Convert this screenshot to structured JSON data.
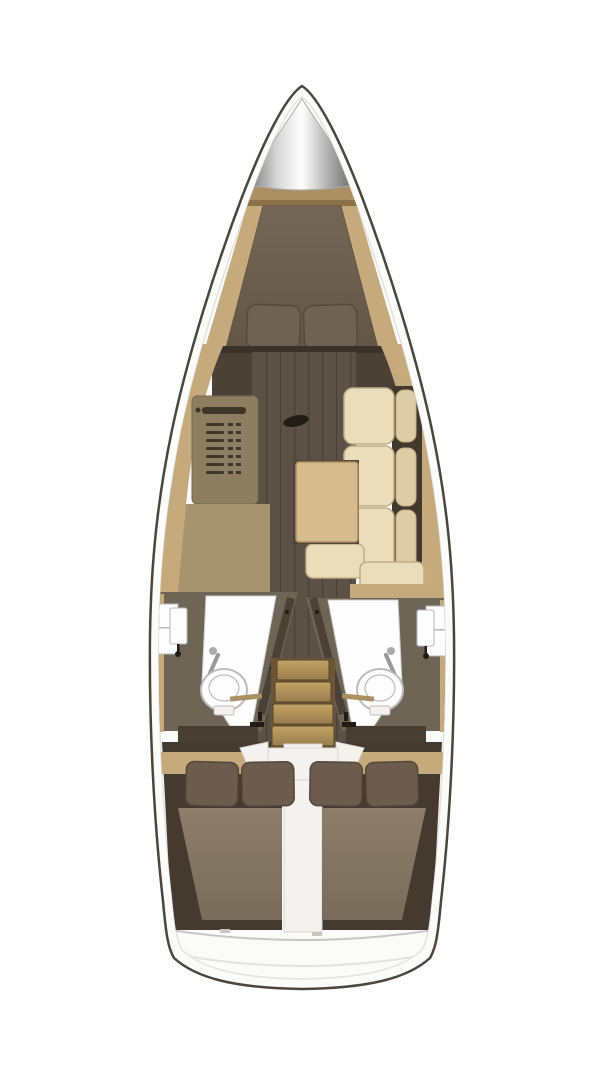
{
  "plan": {
    "regions": [
      "anchor-locker",
      "v-berth-cabin",
      "forward-bulkhead-door",
      "saloon",
      "galley",
      "starboard-settee",
      "saloon-table",
      "port-head",
      "starboard-head",
      "companionway-stairs",
      "engine-compartment",
      "port-aft-cabin",
      "starboard-aft-cabin",
      "stern-transom"
    ]
  },
  "colors": {
    "background": "#ffffff",
    "hull_outline": "#4b453d",
    "deck_white": "#fbfbfa",
    "deck_edge": "#e4e2de",
    "silver_edge": "#6f6f6f",
    "silver_light": "#d6d6d6",
    "silver_white": "#ffffff",
    "silver_mid": "#ababab",
    "silver_edge2": "#5e5e5e",
    "wood_light": "#c4aa7c",
    "wood_mid": "#ab9064",
    "wood_shadow": "#8a7148",
    "bulkhead_dark": "#3a3128",
    "wall_dark": "#4c4136",
    "door_brown": "#5a4c3e",
    "hardware_black": "#211c16",
    "fixture_white": "#fdfdfd",
    "fixture_stroke": "#b9b9b9",
    "floor_dark": "#5b5146",
    "floor_line": "#4a4137",
    "counter_stove": "#8e7e61",
    "counter_stove_edge": "#77684e",
    "stove_detail": "#3e362a",
    "counter_galley": "#a69370",
    "cushion_cream": "#e9ddbb",
    "cushion_cream2": "#dbcda6",
    "cushion_edge": "#bfae85",
    "cushion_gap": "#42382b",
    "table_wood": "#d5bb8d",
    "table_edge": "#ab8d5e",
    "table_shadow": "#4e4439",
    "head_wall": "#6e6556",
    "shower_stroke": "#d0d0d0",
    "shower_wand": "#999999",
    "toilet_stroke": "#bcbcbc",
    "mattress_fwd_light": "#746758",
    "mattress_fwd_dark": "#625646",
    "pillow_fwd": "#6f6153",
    "pillow_stroke": "#574a3d",
    "step_light": "#c2a468",
    "step_dark": "#997c4b",
    "step_edge": "#6b5636",
    "step_seam": "#57452a",
    "engine_white": "#f3f2ef",
    "engine_stroke": "#d7d5d0",
    "cabin_dark": "#453a2f",
    "floor_dark2": "#483f34",
    "pillow_aft": "#6b5c4e",
    "pillow_aft_stroke": "#544739",
    "mattress_aft_light": "#8d7e6b",
    "mattress_aft_dark": "#796c5b",
    "seam_gray": "#c8c6c1",
    "seam_light": "#e4e2dd"
  }
}
